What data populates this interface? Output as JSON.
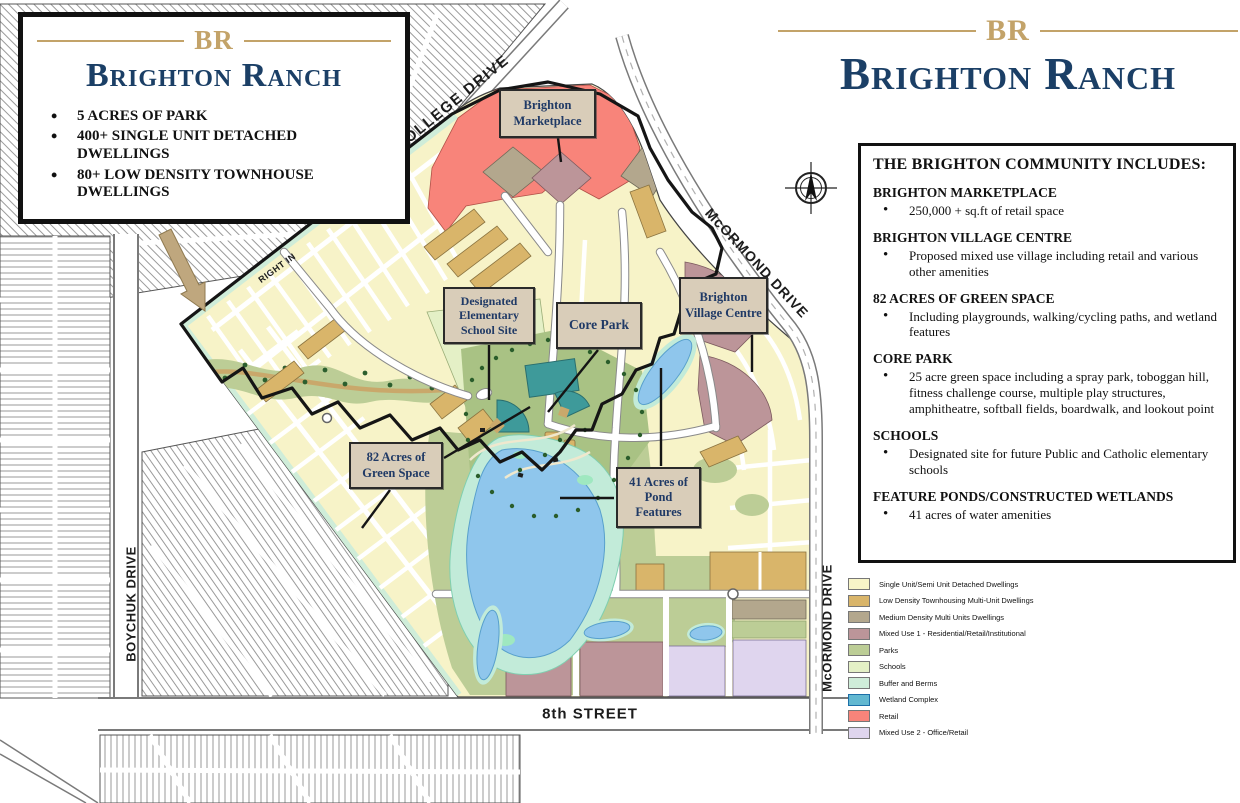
{
  "title_card": {
    "logo": "BR",
    "title": "Brighton Ranch",
    "bullets": [
      "5 ACRES OF PARK",
      "400+ SINGLE UNIT DETACHED DWELLINGS",
      "80+ LOW DENSITY TOWNHOUSE DWELLINGS"
    ]
  },
  "header": {
    "logo": "BR",
    "title": "Brighton Ranch"
  },
  "community_box": {
    "heading": "THE BRIGHTON COMMUNITY INCLUDES:",
    "sections": [
      {
        "title": "BRIGHTON MARKETPLACE",
        "desc": "250,000 + sq.ft of retail space"
      },
      {
        "title": "BRIGHTON VILLAGE CENTRE",
        "desc": "Proposed mixed use village including retail and various other amenities"
      },
      {
        "title": "82 ACRES OF GREEN SPACE",
        "desc": "Including playgrounds, walking/cycling paths, and wetland features"
      },
      {
        "title": "CORE PARK",
        "desc": "25 acre green space including a spray park, toboggan hill, fitness challenge course, multiple play structures, amphitheatre, softball fields, boardwalk, and lookout point"
      },
      {
        "title": "SCHOOLS",
        "desc": "Designated site for future Public and Catholic elementary schools"
      },
      {
        "title": "FEATURE PONDS/CONSTRUCTED WETLANDS",
        "desc": "41 acres of water amenities"
      }
    ]
  },
  "legend": {
    "items": [
      {
        "label": "Single Unit/Semi Unit Detached Dwellings",
        "color": "#F8F5C8",
        "border": "#777777"
      },
      {
        "label": "Low Density Townhousing Multi-Unit Dwellings",
        "color": "#D9B56A",
        "border": "#777777"
      },
      {
        "label": "Medium Density Multi Units Dwellings",
        "color": "#B3A78D",
        "border": "#777777"
      },
      {
        "label": "Mixed Use 1 - Residential/Retail/Institutional",
        "color": "#BC9599",
        "border": "#777777"
      },
      {
        "label": "Parks",
        "color": "#BCCD96",
        "border": "#777777"
      },
      {
        "label": "Schools",
        "color": "#E4F0C6",
        "border": "#777777"
      },
      {
        "label": "Buffer and Berms",
        "color": "#CFEDD9",
        "border": "#777777"
      },
      {
        "label": "Wetland Complex",
        "color": "#62B8D1",
        "border": "#1d6fa8"
      },
      {
        "label": "Retail",
        "color": "#F8847A",
        "border": "#777777"
      },
      {
        "label": "Mixed Use 2 - Office/Retail",
        "color": "#DFD5EE",
        "border": "#777777"
      }
    ]
  },
  "map": {
    "street_labels": {
      "college": "COLLEGE DRIVE",
      "mcormond_upper": "McORMOND DRIVE",
      "mcormond_lower": "McORMOND DRIVE",
      "boychuk": "BOYCHUK DRIVE",
      "eighth_street": "8th STREET",
      "right_in": "RIGHT IN"
    },
    "feature_labels": {
      "marketplace": "Brighton Marketplace",
      "school_site": "Designated Elementary School Site",
      "core_park": "Core Park",
      "village_centre": "Brighton Village Centre",
      "green_space": "82 Acres of Green Space",
      "pond_features": "41 Acres of Pond Features"
    }
  }
}
